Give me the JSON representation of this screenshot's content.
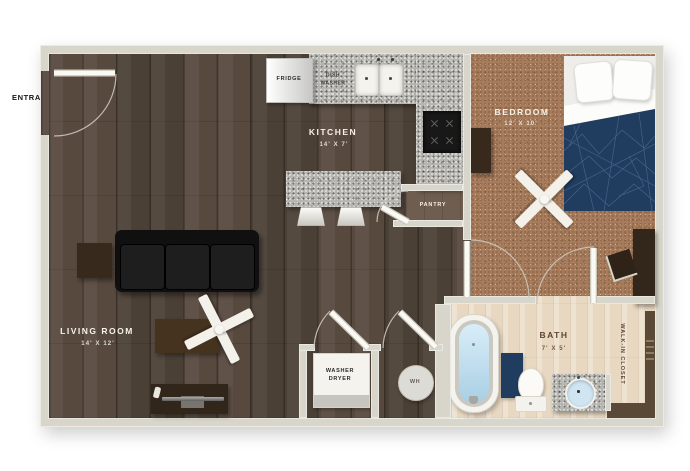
{
  "entrance": {
    "label": "ENTRANCE"
  },
  "rooms": {
    "living_room": {
      "name": "LIVING ROOM",
      "dims": "14' X 12'"
    },
    "kitchen": {
      "name": "KITCHEN",
      "dims": "14' X 7'"
    },
    "bedroom": {
      "name": "BEDROOM",
      "dims": "12' X 10'"
    },
    "bath": {
      "name": "BATH",
      "dims": "7' X 5'"
    },
    "pantry": {
      "name": "PANTRY"
    },
    "closet": {
      "name": "WALK-IN CLOSET"
    }
  },
  "fixtures": {
    "fridge": "FRIDGE",
    "dishwasher": "DISH\nWASHER",
    "washer_dryer": "WASHER\nDRYER",
    "water_heater": "WH"
  },
  "colors": {
    "wall": "#d8d5ca",
    "dark_wood_floor": "#4f443a",
    "bedroom_carpet": "#a67c5d",
    "bath_light_wood": "#e9d8c1",
    "granite_counter": "#b6b5b0",
    "blanket_navy": "#203c5e",
    "sofa_black": "#131313",
    "furniture_brown": "#38291d",
    "tub_water_blue": "#bfdff0"
  }
}
